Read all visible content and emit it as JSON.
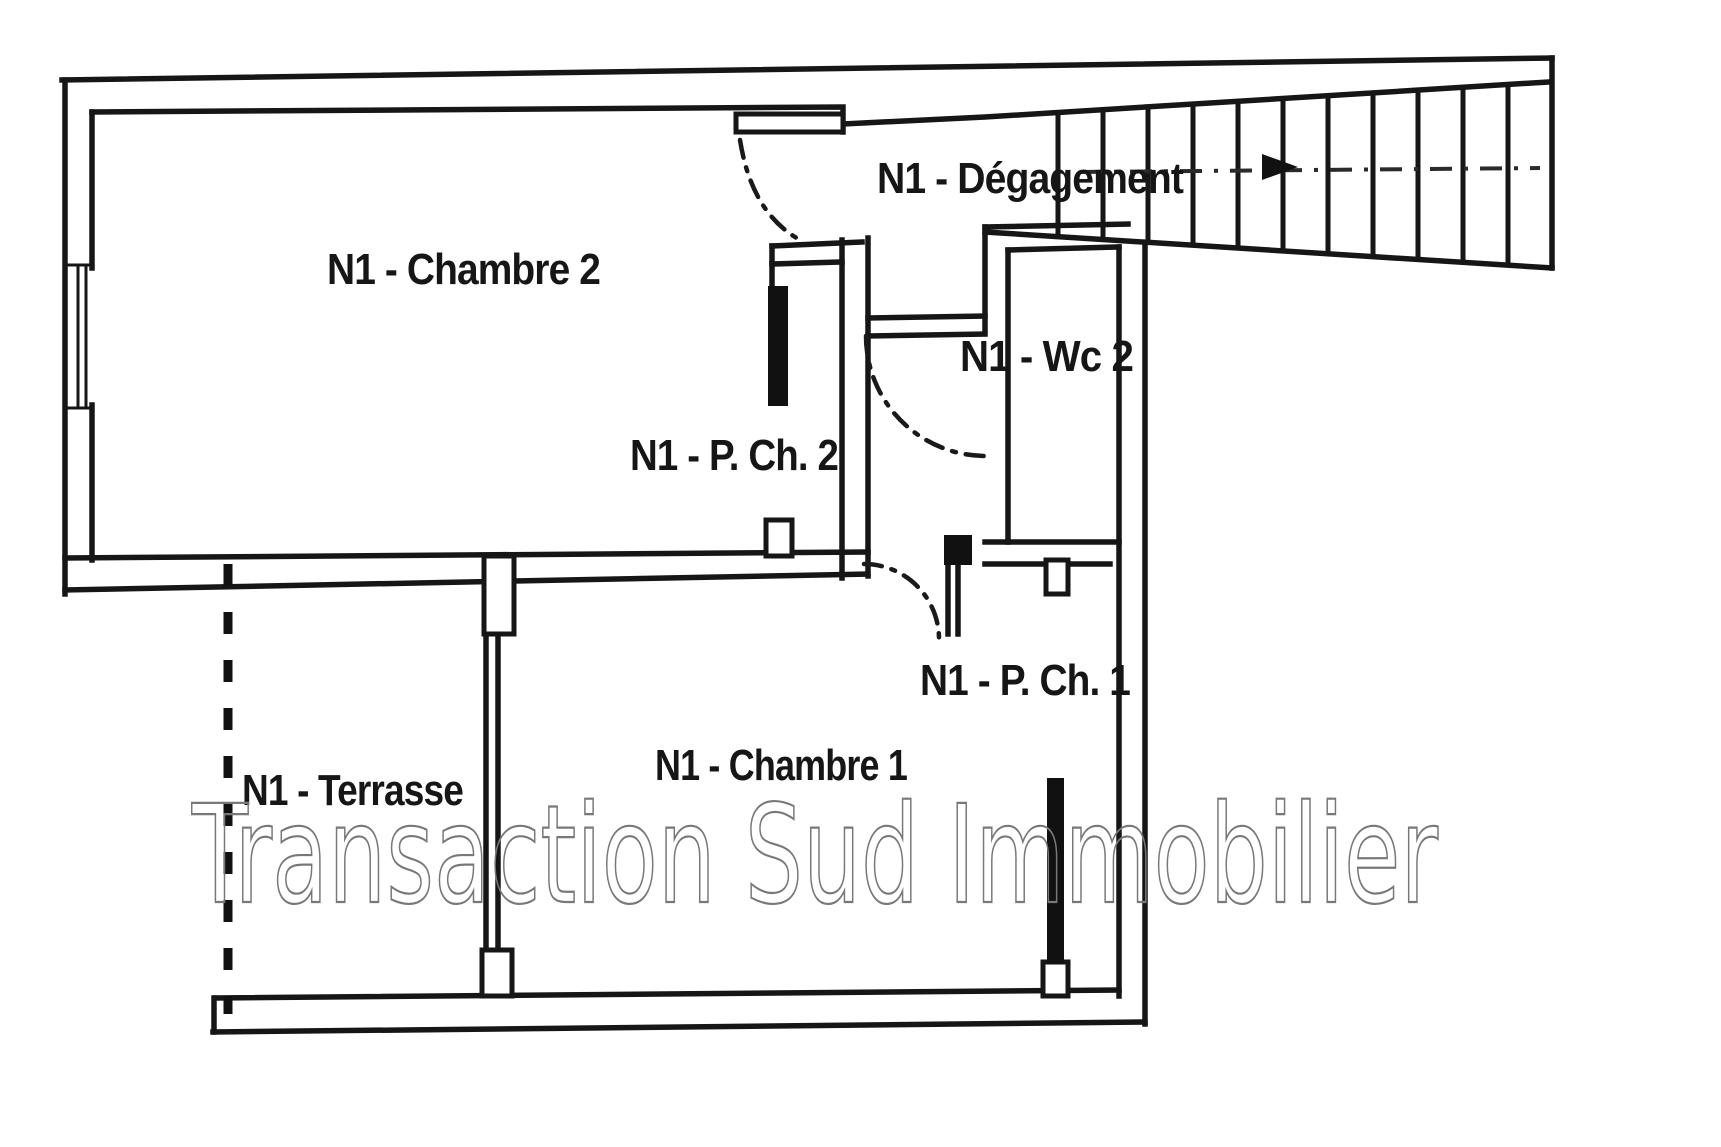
{
  "scan": {
    "background": "#ffffff",
    "ink": "#161616",
    "watermark_color": "#787878"
  },
  "floorplan": {
    "level_prefix": "N1",
    "rooms": [
      {
        "id": "degagement",
        "label": "N1 - Dégagement"
      },
      {
        "id": "chambre2",
        "label": "N1 - Chambre 2"
      },
      {
        "id": "wc2",
        "label": "N1 - Wc 2"
      },
      {
        "id": "placard_chambre2",
        "label": "N1 - P. Ch. 2"
      },
      {
        "id": "placard_chambre1",
        "label": "N1 - P. Ch. 1"
      },
      {
        "id": "chambre1",
        "label": "N1 - Chambre 1"
      },
      {
        "id": "terrasse",
        "label": "N1 - Terrasse"
      }
    ],
    "stairs": {
      "treads": 11,
      "direction_line_style": "dash-dot"
    },
    "door_swings": 3,
    "terrace_boundary_style": "dashed"
  },
  "watermark": {
    "text": "Transaction Sud Immobilier"
  }
}
